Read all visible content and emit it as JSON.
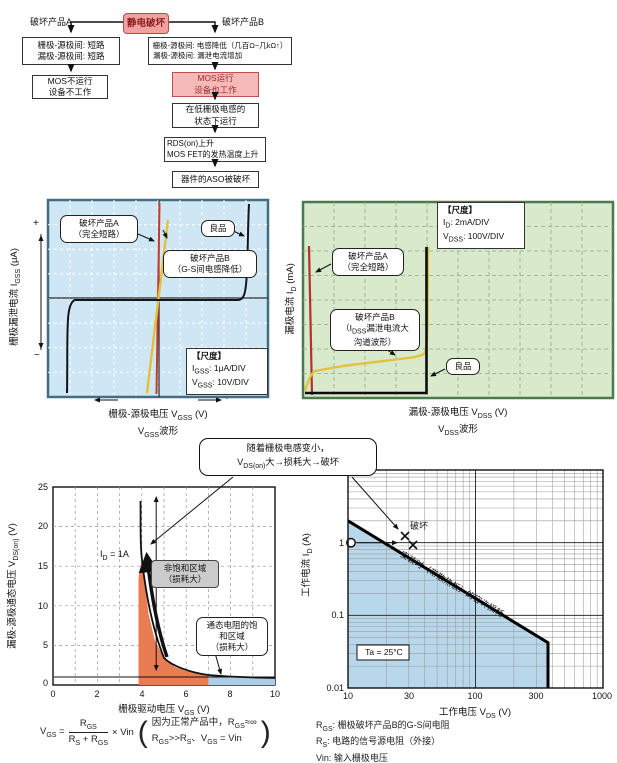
{
  "colors": {
    "accent_pink": "#f0a2a2",
    "panel_blue": "#cfe7f4",
    "panel_green": "#d8e9cc",
    "curve_red": "#c23b2e",
    "curve_yellow": "#e2c23c",
    "fill_orange": "#e97c52",
    "fill_blue": "#a9cee6",
    "good_black": "#111111"
  },
  "flowchart": {
    "title": "静电破坏",
    "product_a": "破坏产品A",
    "product_b": "破坏产品B",
    "box_a1": [
      "栅极-源极间: 短路",
      "漏极-源极间: 短路"
    ],
    "box_b1": [
      "栅极-源极间: 电感降低（几百Ω~几kΩ↑）",
      "漏极-源极间: 漏泄电流增加"
    ],
    "box_a2": [
      "MOS不运行",
      "设备不工作"
    ],
    "box_b2": [
      "MOS运行",
      "设备也工作"
    ],
    "box_b3": [
      "在低栅极电感的",
      "状态下运行"
    ],
    "box_b4": [
      "RDS(on)上升",
      "MOS FET的发热温度上升"
    ],
    "box_b5": "器件的ASO被破坏"
  },
  "gss_chart": {
    "bubble_a": [
      "破坏产品A",
      "（完全短路）"
    ],
    "bubble_b": [
      "破坏产品B",
      "（G-S间电感降低）"
    ],
    "good_label": "良品",
    "zero": "0",
    "scale_title": "【尺度】",
    "scale_line1": "I_{GSS}: 1μA/DIV",
    "scale_line2": "V_{GSS}: 10V/DIV",
    "y_label": "栅极漏泄电流 I_{GSS} (μA)",
    "x_label": "栅极-源极电压 V_{GSS} (V)",
    "x_sub": "V_{GSS}波形",
    "plus": "+",
    "minus": "−"
  },
  "vdss_chart": {
    "scale_title": "【尺度】",
    "scale_line1": "I_{D}: 2mA/DIV",
    "scale_line2": "V_{DSS}: 100V/DIV",
    "bubble_a": [
      "破坏产品A",
      "（完全短路）"
    ],
    "bubble_b": [
      "破坏产品B",
      "（I_{DSS}漏泄电流大",
      "沟道波形）"
    ],
    "good_label": "良品",
    "y_label": "漏极电流 I_{D} (mA)",
    "x_label": "漏极-源极电压 V_{DSS} (V)",
    "x_sub": "V_{DSS}波形"
  },
  "callout": {
    "line1": "随着栅极电感变小，",
    "line2": "V_{DS(on)}大→损耗大→破坏"
  },
  "bl_chart": {
    "y_ticks": [
      "25",
      "20",
      "15",
      "10",
      "5",
      "0"
    ],
    "x_ticks": [
      "0",
      "2",
      "4",
      "6",
      "8",
      "10"
    ],
    "id_label": "I_{D} = 1A",
    "region1": [
      "非饱和区域",
      "（损耗大）"
    ],
    "region2": [
      "通态电阻的饱",
      "和区域",
      "（损耗大）"
    ],
    "x_label": "栅极驱动电压 V_{GS} (V)",
    "y_label": "漏极-源极通态电压 V_{DS(on)} (V)"
  },
  "formula": {
    "lhs": "V_{GS} =",
    "num": "R_{GS}",
    "den": "R_{S} + R_{GS}",
    "mult": "× Vin",
    "paren_open": "(",
    "paren_close": ")",
    "note1": "因为正常产品中，R_{GS}≈∞",
    "note2": "R_{GS}>>R_{S}、V_{GS} = Vin"
  },
  "br_chart": {
    "y_ticks": [
      "10",
      "1",
      "0.1",
      "0.01"
    ],
    "x_ticks": [
      "10",
      "30",
      "100",
      "300",
      "1000"
    ],
    "damage_label": "破坏",
    "diag_label": "安装时（带散热板）的容许损耗",
    "ta_label": "Ta = 25°C",
    "y_label": "工作电流 I_{D} (A)",
    "x_label": "工作电压 V_{DS} (V)"
  },
  "legend": {
    "line1": "R_{GS}: 栅极破坏产品B的G-S间电阻",
    "line2": "R_{S}: 电路的信号源电阻（外接）",
    "line3": "Vin: 输入栅极电压"
  },
  "chart_data": [
    {
      "type": "line",
      "title": "VGSS波形",
      "xlabel": "栅极-源极电压 VGSS (V)",
      "ylabel": "栅极漏泄电流 IGSS (μA)",
      "x_scale": "10V/DIV",
      "y_scale": "1μA/DIV",
      "grid": "10x8 divisions",
      "series": [
        {
          "name": "破坏产品A（完全短路）",
          "description": "vertical line at VGSS≈0 (dead short)"
        },
        {
          "name": "破坏产品B（G-S间电感降低）",
          "description": "steep resistive line through origin"
        },
        {
          "name": "良品",
          "description": "near-zero leakage across sweep, sharp breakdown at sweep extremes"
        }
      ]
    },
    {
      "type": "line",
      "title": "VDSS波形",
      "xlabel": "漏极-源极电压 VDSS (V)",
      "ylabel": "漏极电流 ID (mA)",
      "x_scale": "100V/DIV",
      "y_scale": "2mA/DIV",
      "grid": "10x8 divisions",
      "series": [
        {
          "name": "破坏产品A（完全短路）",
          "description": "vertical line near VDSS≈0"
        },
        {
          "name": "破坏产品B（IDSS漏泄电流大，沟道波形）",
          "description": "large leakage current rising slowly, breakdown at ≈4 divisions"
        },
        {
          "name": "良品",
          "description": "zero current then sharp breakdown at ≈4 divisions"
        }
      ]
    },
    {
      "type": "line",
      "title": "VDS(on) vs VGS",
      "xlabel": "栅极驱动电压 VGS (V)",
      "ylabel": "漏极-源极通态电压 VDS(on) (V)",
      "xlim": [
        0,
        10
      ],
      "ylim": [
        0,
        25
      ],
      "condition": "ID = 1A",
      "points": [
        [
          3.9,
          25
        ],
        [
          4.0,
          16
        ],
        [
          4.5,
          6
        ],
        [
          5,
          3.2
        ],
        [
          5.5,
          2.2
        ],
        [
          6,
          1.7
        ],
        [
          6.5,
          1.4
        ],
        [
          7,
          1.2
        ],
        [
          8,
          1.0
        ],
        [
          9,
          0.95
        ],
        [
          10,
          0.9
        ]
      ],
      "regions": [
        {
          "label": "非饱和区域（损耗大）",
          "x": [
            3.9,
            7
          ],
          "fill": "orange"
        },
        {
          "label": "通态电阻的饱和区域（损耗大）",
          "x": [
            7,
            10
          ],
          "fill": "blue"
        }
      ]
    },
    {
      "type": "line",
      "title": "ASO / 容许损耗",
      "xlabel": "工作电压 VDS (V)",
      "ylabel": "工作电流 ID (A)",
      "xscale": "log",
      "yscale": "log",
      "xlim": [
        10,
        1000
      ],
      "ylim": [
        0.01,
        10
      ],
      "condition": "Ta = 25°C",
      "aso_limit": [
        [
          10,
          2
        ],
        [
          450,
          0.045
        ],
        [
          450,
          0.01
        ]
      ],
      "operating_point": [
        10,
        1
      ],
      "failure_points": [
        [
          28,
          1.1
        ],
        [
          33,
          0.9
        ]
      ],
      "annotation": "安装时（带散热板）的容许损耗"
    }
  ]
}
